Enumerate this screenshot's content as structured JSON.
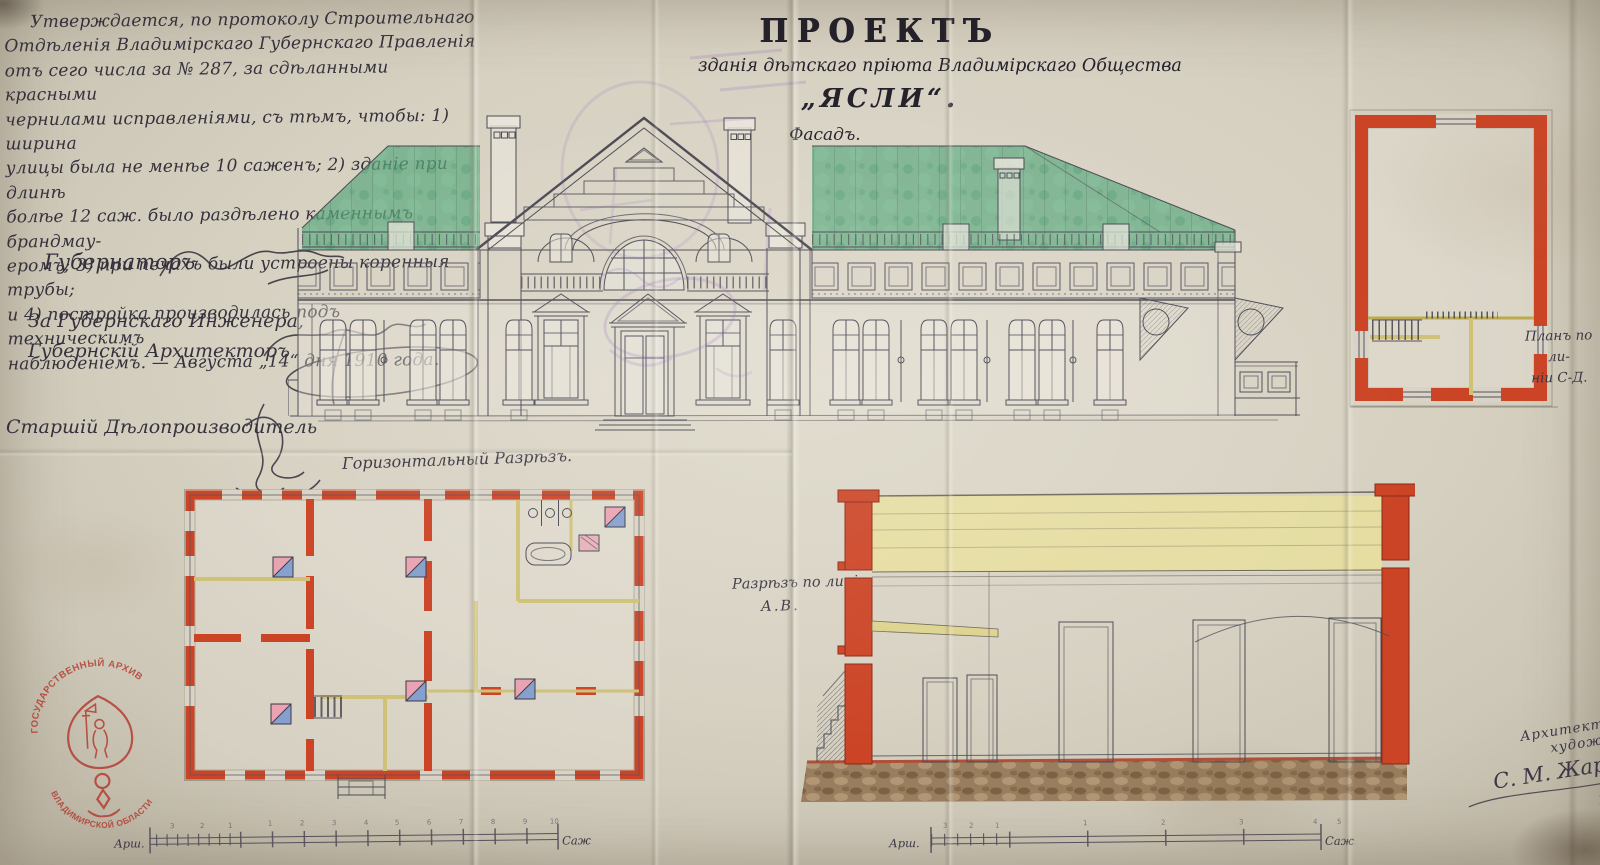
{
  "doc": {
    "approval": {
      "lines": [
        "Утверждается, по протоколу Строительнаго",
        "Отдѣленія Владимірскаго Губернскаго Правленія",
        "отъ сего числа за № 287, за сдѣланными красными",
        "чернилами исправленіями, съ тѣмъ, чтобы: 1) ширина",
        "улицы была не менѣе 10 саженъ; 2) зданіе при длинѣ",
        "болѣе 12 саж. было раздѣлено каменнымъ брандмау-",
        "еромъ; 3) при печахъ были устроены коренныя трубы;",
        "и 4) постройка производилась подъ техническимъ",
        "наблюденіемъ. — Августа „14“ дня 1910 года."
      ]
    },
    "signatures": {
      "governor_title": "Губернаторъ",
      "engineer_for_title": "За Губернскаго Инженера,",
      "architect_title": "Губернскій Архитекторъ",
      "clerk_title": "Старшій Дѣлопроизводитель"
    },
    "title_block": {
      "heading": "ПРОЕКТЪ",
      "subtitle": "зданія дѣтскаго пріюта Владимірскаго Общества",
      "building_name": "„ЯСЛИ“.",
      "view_label": "Фасадъ."
    },
    "drawing_labels": {
      "horizontal_section": "Горизонтальный Разрѣзъ.",
      "section_line_1": "Разрѣзъ по линіи",
      "section_line_2": "А.В.",
      "side_plan_line_1": "Планъ по ли-",
      "side_plan_line_2": "ніи С-Д."
    },
    "credit": {
      "role": "Архитекторъ-художникъ",
      "signature": "С. М. Жаровъ",
      "year": "1910 г."
    },
    "scale_bars": {
      "left": {
        "arshin_label": "Арш.",
        "sazhen_label": "Саж.",
        "arshin_ticks": [
          "3",
          "2",
          "1"
        ],
        "sazhen_ticks": [
          "1",
          "2",
          "3",
          "4",
          "5",
          "6",
          "7",
          "8",
          "9",
          "10"
        ]
      },
      "right": {
        "arshin_label": "Арш.",
        "sazhen_label": "Саж.",
        "arshin_ticks": [
          "3",
          "2",
          "1"
        ],
        "sazhen_ticks": [
          "1",
          "2",
          "3",
          "4",
          "5"
        ]
      }
    },
    "archive_stamp": {
      "top_text": "ГОСУДАРСТВЕННЫЙ АРХИВ",
      "bottom_text": "ВЛАДИМИРСКОЙ ОБЛАСТИ"
    },
    "colors": {
      "wall_red": "#cc4426",
      "roof_green": "#5ba87d",
      "partition_yellow": "#cfc176",
      "attic_yellow": "#e7de9f",
      "stove_pink": "#e9a3b2",
      "stove_blue": "#85a0ce",
      "foundation_brown": "#8a6a47",
      "ink": "#4b4a55",
      "stamp_red": "#b23227",
      "violet_mark": "#8a5fbe",
      "paper": "#d7d1c2"
    }
  }
}
